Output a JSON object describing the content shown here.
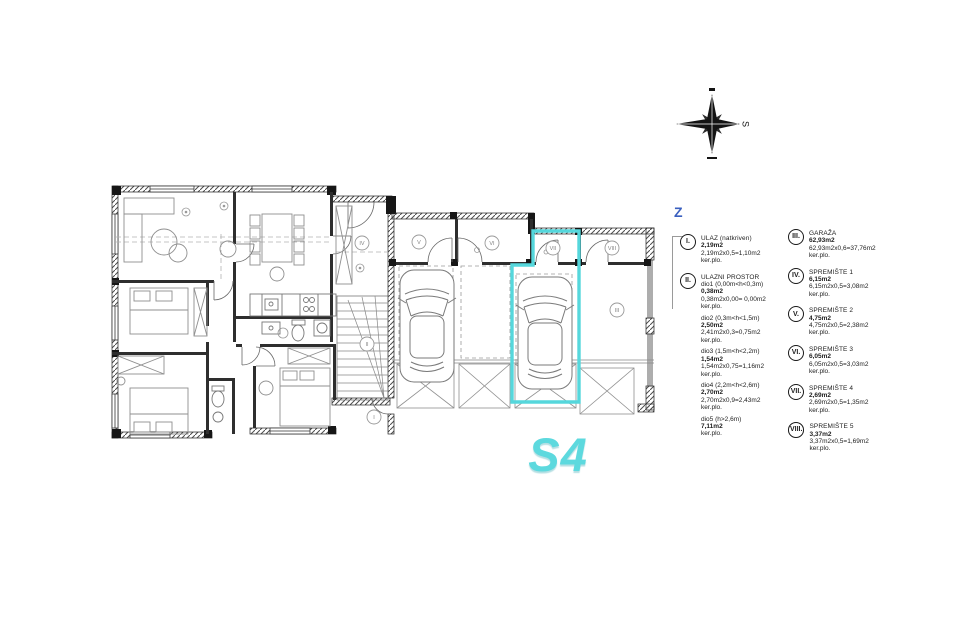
{
  "unit": {
    "label": "S4",
    "color": "#5bd8de"
  },
  "section_marker": "Z",
  "compass": {
    "letter": "S"
  },
  "plan_labels": [
    {
      "label": "I",
      "x": 374,
      "y": 417
    },
    {
      "label": "II",
      "x": 367,
      "y": 344
    },
    {
      "label": "III",
      "x": 617,
      "y": 310
    },
    {
      "label": "IV",
      "x": 362,
      "y": 243
    },
    {
      "label": "V",
      "x": 419,
      "y": 242
    },
    {
      "label": "VI",
      "x": 492,
      "y": 243
    },
    {
      "label": "VII",
      "x": 553,
      "y": 248
    },
    {
      "label": "VIII",
      "x": 612,
      "y": 248
    }
  ],
  "legend": {
    "items": [
      {
        "numeral": "I.",
        "name": "ULAZ (natkriven)",
        "lines": [
          {
            "t": "2,19m2",
            "b": 1
          },
          {
            "t": "2,19m2x0,5=1,10m2"
          },
          {
            "t": "ker.plo."
          }
        ]
      },
      {
        "numeral": "II.",
        "name": "ULAZNI PROSTOR",
        "lines": [
          {
            "t": "dio1 (0,00m<h<0,3m)"
          },
          {
            "t": "0,38m2",
            "b": 1
          },
          {
            "t": "0,38m2x0,00= 0,00m2"
          },
          {
            "t": "ker.plo."
          },
          {
            "t": "dio2 (0,3m<h<1,5m)",
            "gap": 1
          },
          {
            "t": "2,50m2",
            "b": 1
          },
          {
            "t": "2,41m2x0,3=0,75m2"
          },
          {
            "t": "ker.plo."
          },
          {
            "t": "dio3 (1,5m<h<2,2m)",
            "gap": 1
          },
          {
            "t": "1,54m2",
            "b": 1
          },
          {
            "t": "1,54m2x0,75=1,16m2"
          },
          {
            "t": "ker.plo."
          },
          {
            "t": "dio4 (2,2m<h<2,6m)",
            "gap": 1
          },
          {
            "t": "2,70m2",
            "b": 1
          },
          {
            "t": "2,70m2x0,9=2,43m2"
          },
          {
            "t": "ker.plo."
          },
          {
            "t": "dio5 (h>2,6m)",
            "gap": 1
          },
          {
            "t": "7,11m2",
            "b": 1
          },
          {
            "t": "ker.plo."
          }
        ]
      },
      {
        "numeral": "III.",
        "name": "GARAŽA",
        "lines": [
          {
            "t": "62,93m2",
            "b": 1
          },
          {
            "t": "62,93m2x0,6=37,76m2"
          },
          {
            "t": "ker.plo."
          }
        ]
      },
      {
        "numeral": "IV.",
        "name": "SPREMIŠTE 1",
        "lines": [
          {
            "t": "6,15m2",
            "b": 1
          },
          {
            "t": "6,15m2x0,5=3,08m2"
          },
          {
            "t": "ker.plo."
          }
        ]
      },
      {
        "numeral": "V.",
        "name": "SPREMIŠTE 2",
        "lines": [
          {
            "t": "4,75m2",
            "b": 1
          },
          {
            "t": "4,75m2x0,5=2,38m2"
          },
          {
            "t": "ker.plo."
          }
        ]
      },
      {
        "numeral": "VI.",
        "name": "SPREMIŠTE 3",
        "lines": [
          {
            "t": "6,05m2",
            "b": 1
          },
          {
            "t": "6,05m2x0,5=3,03m2"
          },
          {
            "t": "ker.plo."
          }
        ]
      },
      {
        "numeral": "VII.",
        "name": "SPREMIŠTE 4",
        "lines": [
          {
            "t": "2,69m2",
            "b": 1
          },
          {
            "t": "2,69m2x0,5=1,35m2"
          },
          {
            "t": "ker.plo."
          }
        ]
      },
      {
        "numeral": "VIII.",
        "name": "SPREMIŠTE 5",
        "lines": [
          {
            "t": "3,37m2",
            "b": 1
          },
          {
            "t": "3,37m2x0,5=1,69m2"
          },
          {
            "t": "ker.plo."
          }
        ]
      }
    ]
  }
}
